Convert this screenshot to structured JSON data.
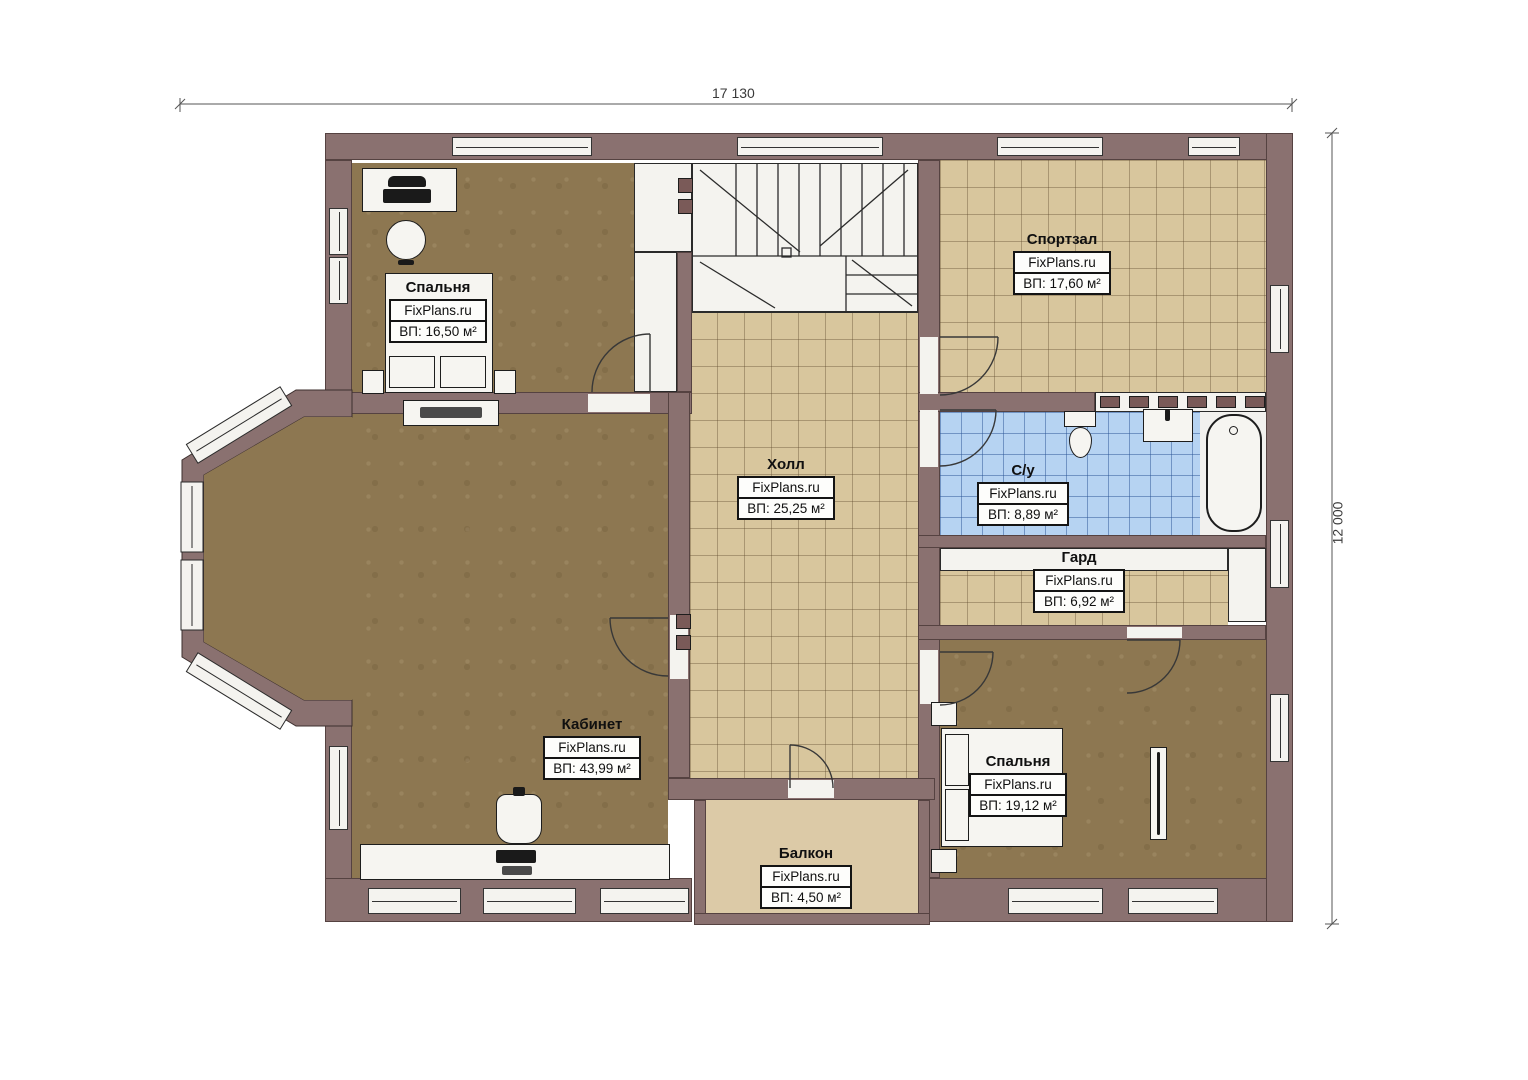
{
  "plan": {
    "watermark": "FixPlans.ru",
    "dimensions": {
      "width_label": "17 130",
      "height_label": "12 000"
    },
    "rooms": [
      {
        "name": "Спальня",
        "watermark": "FixPlans.ru",
        "area": "ВП: 16,50 м²"
      },
      {
        "name": "Спортзал",
        "watermark": "FixPlans.ru",
        "area": "ВП: 17,60 м²"
      },
      {
        "name": "Холл",
        "watermark": "FixPlans.ru",
        "area": "ВП: 25,25 м²"
      },
      {
        "name": "С/у",
        "watermark": "FixPlans.ru",
        "area": "ВП: 8,89 м²"
      },
      {
        "name": "Гард",
        "watermark": "FixPlans.ru",
        "area": "ВП: 6,92 м²"
      },
      {
        "name": "Кабинет",
        "watermark": "FixPlans.ru",
        "area": "ВП: 43,99 м²"
      },
      {
        "name": "Спальня",
        "watermark": "FixPlans.ru",
        "area": "ВП: 19,12 м²"
      },
      {
        "name": "Балкон",
        "watermark": "FixPlans.ru",
        "area": "ВП: 4,50 м²"
      }
    ],
    "colors": {
      "wall": "#8a7170",
      "carpet_floor": "#8d7751",
      "tile_floor": "#d8c69d",
      "bathroom_tile": "#b6d3f2",
      "balcony_floor": "#dccaa7"
    }
  }
}
